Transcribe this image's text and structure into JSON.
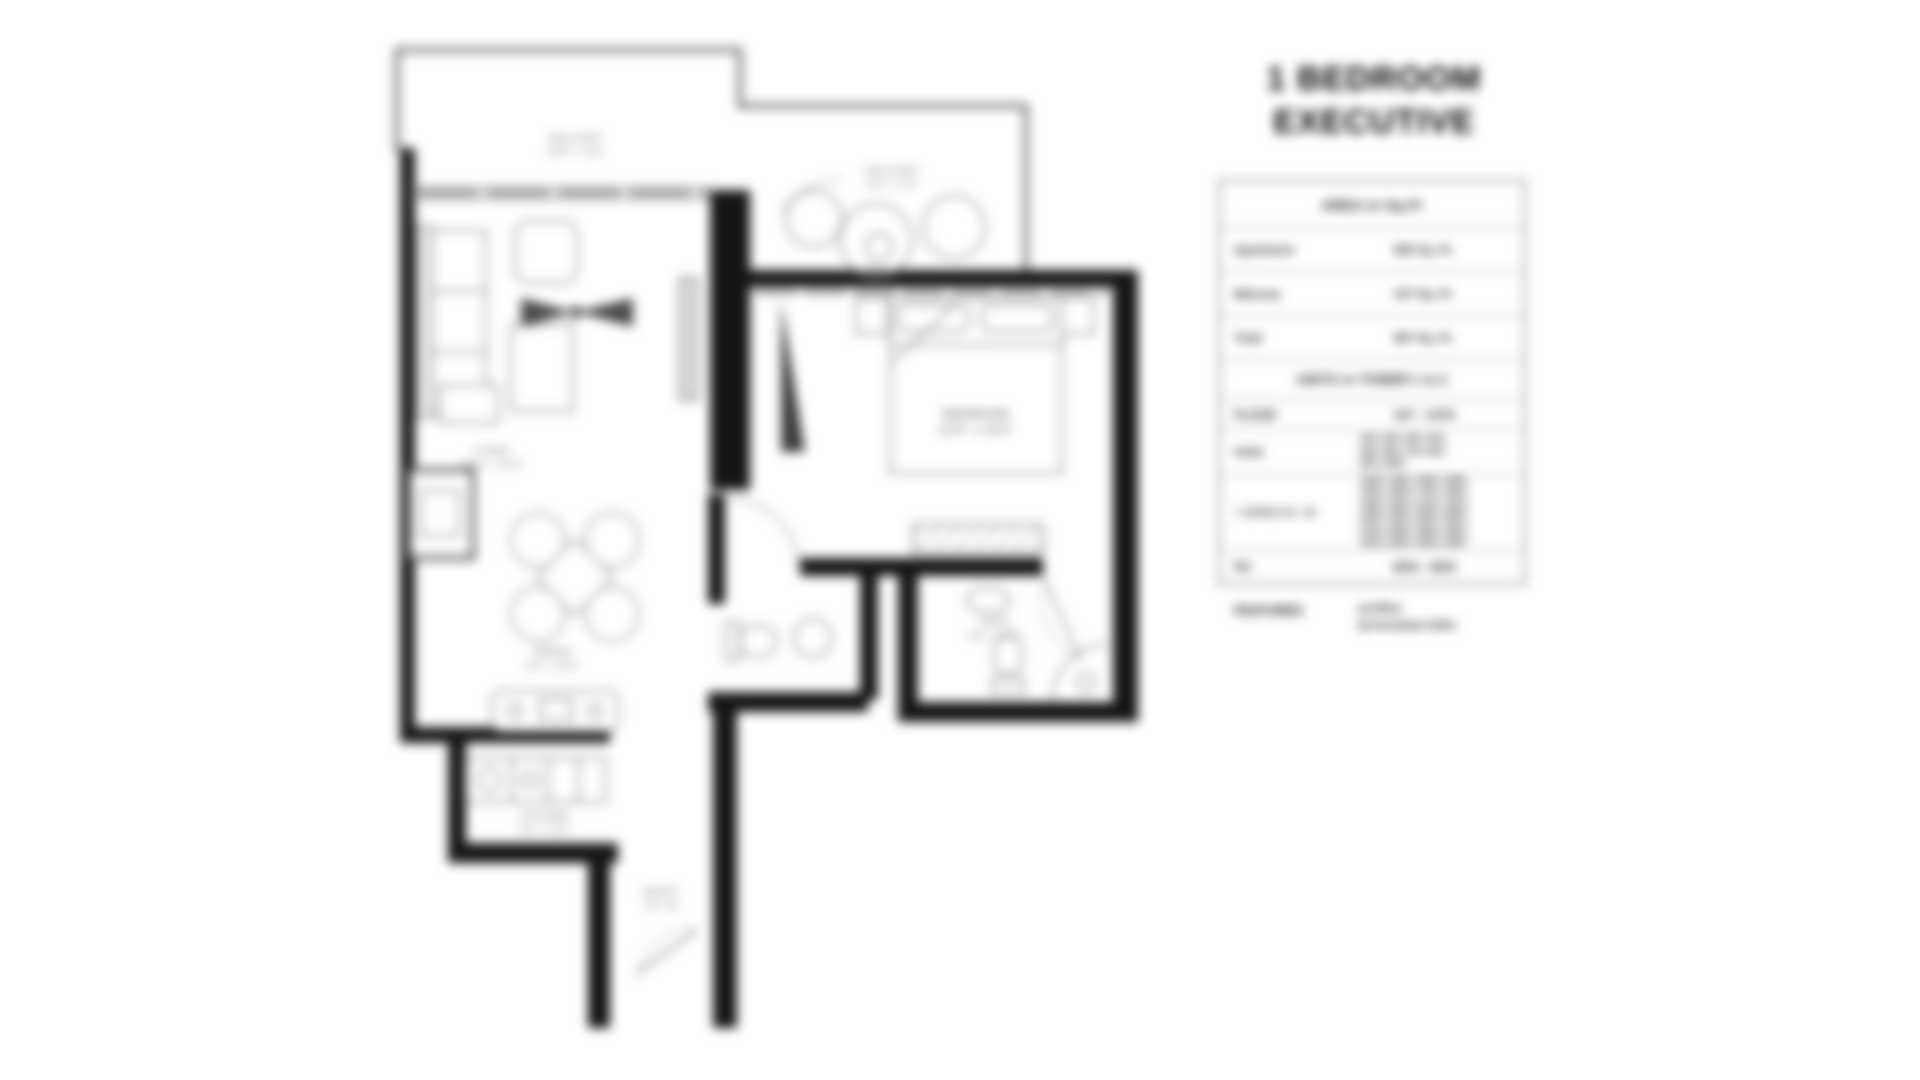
{
  "title": {
    "line1": "1 BEDROOM",
    "line2": "EXECUTIVE"
  },
  "plan_labels": {
    "balcony_top": {
      "name": "BALCONY",
      "dims": "14'8\" x 4'6\""
    },
    "balcony_side": {
      "name": "BALCONY",
      "dims": "9'2\" x 7'6\""
    },
    "living": {
      "name": "LIVING",
      "dims": "12'6\" x 11'0\""
    },
    "dining": {
      "name": "DINING",
      "dims": "9'0\" x 8'6\""
    },
    "bedroom": {
      "name": "BEDROOM",
      "dims": "11'6\" x 10'0\""
    },
    "bath": {
      "name": "BATH",
      "dims": "8'0\" x 5'0\""
    },
    "kitchen": {
      "name": "KITCHEN",
      "dims": "7'6\" x 5'0\""
    },
    "entry": {
      "name": "ENTRY",
      "dims": "4'0\" W"
    }
  },
  "panel": {
    "area_table": {
      "header": "AREA in Sq.Ft",
      "rows": [
        {
          "label": "Apartment",
          "value": "560 Sq. Ft."
        },
        {
          "label": "Balcony",
          "value": "107 Sq. Ft."
        },
        {
          "label": "Total",
          "value": "667 Sq. Ft."
        }
      ]
    },
    "units_table": {
      "header": "UNITS in TOWER 1 & 2",
      "floor_row": {
        "label": "FLOOR",
        "value": "1ST - 14TH"
      },
      "units_row": {
        "label": "Units",
        "value": "104, 204, 304, 404,\n504, 604, 704, 804,\n904, 1004"
      },
      "levels_row": {
        "label": "+ LEVELS 15 - 34",
        "value": "1104, 1204, 1304, 1404,\n1504, 1604, 1704, 1804,\n1904, 2004, 2104, 2204,\n2304, 2404, 2504, 2604,\n2704, 2804, 2904, 3004,\n3104, 3204, 3304, 3404"
      },
      "ph_row": {
        "label": "PH",
        "value": "3504 - 3604"
      }
    },
    "features": {
      "label": "FEATURES",
      "items": "a) Office\nb) Furnished 100%"
    }
  },
  "colors": {
    "wall": "#151515",
    "outline": "#6e6e6e",
    "furniture": "#9a9a9a",
    "label": "#8c8c8c"
  }
}
